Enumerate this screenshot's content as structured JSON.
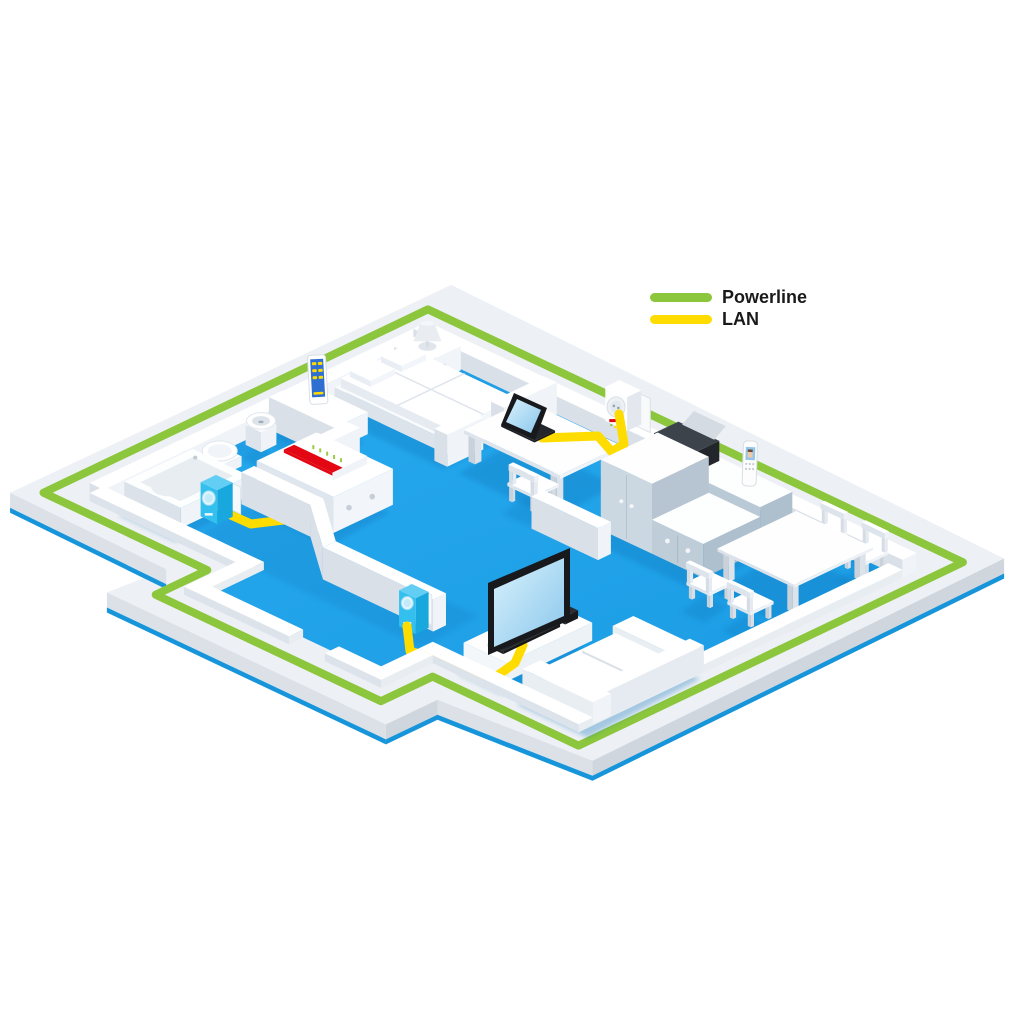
{
  "page": {
    "background": "#FFFFFF",
    "description": "Isometric cutaway apartment illustration showing a Powerline home network with LAN-connected devices"
  },
  "legend": {
    "items": [
      {
        "id": "powerline",
        "label": "Powerline",
        "color": "#8CC63C"
      },
      {
        "id": "lan",
        "label": "LAN",
        "color": "#FFDC00"
      }
    ]
  },
  "colors": {
    "floor_blue_light": "#27A9EE",
    "floor_blue": "#1B9CE4",
    "floor_shadow": "#0B76BB",
    "powerline_green": "#8CC63C",
    "lan_yellow": "#FFDC00",
    "wall_top": "#FFFFFF",
    "wall_face_light": "#F0F4F8",
    "wall_face_mid": "#D9E0E8",
    "plinth_top": "#EDF0F4",
    "plinth_side_light": "#DCE1E8",
    "plinth_side_dark": "#CFD6DD",
    "base_blue_edge": "#1795DB",
    "cabinet_blue_gray": "#B9C9D6",
    "cabinet_blue_gray_dark": "#AEBFCD",
    "device_cyan": "#33C0EF",
    "device_cyan_dark": "#18A8DD",
    "device_cyan_top": "#63CEF3",
    "fritz_red": "#E30613",
    "dark": "#17191C",
    "screen_blue_light": "#D9F1FC",
    "screen_blue": "#8AC7EC",
    "phone_screen": "#92C5E9",
    "smartphone_screen": "#2F6FD1"
  },
  "scene": {
    "rooms": [
      "bedroom",
      "bathroom",
      "hallway",
      "home-office",
      "kitchen",
      "dining-area",
      "living-room",
      "entry-porch"
    ],
    "objects": [
      "bed",
      "pillows",
      "nightstand",
      "table-lamp",
      "bedroom-sideboard",
      "smartphone",
      "bathtub",
      "toilet",
      "washbasin",
      "hall-cabinet",
      "fritzbox-router",
      "powerline-adapter-hall",
      "desk",
      "laptop",
      "desk-chair",
      "powerline-adapter-wall-socket",
      "kitchen-counter",
      "printer",
      "cordless-phone",
      "kitchen-cupboard",
      "kitchen-counter-2",
      "dining-table",
      "dining-chairs",
      "tv-bench",
      "tv",
      "media-box",
      "powerline-adapter-tv",
      "sofa"
    ],
    "network": {
      "powerline_ring": "green ribbon around the outer walls",
      "lan_links": [
        "router to hall powerline adapter",
        "laptop to wall powerline adapter",
        "tv to tv powerline adapter"
      ]
    }
  }
}
